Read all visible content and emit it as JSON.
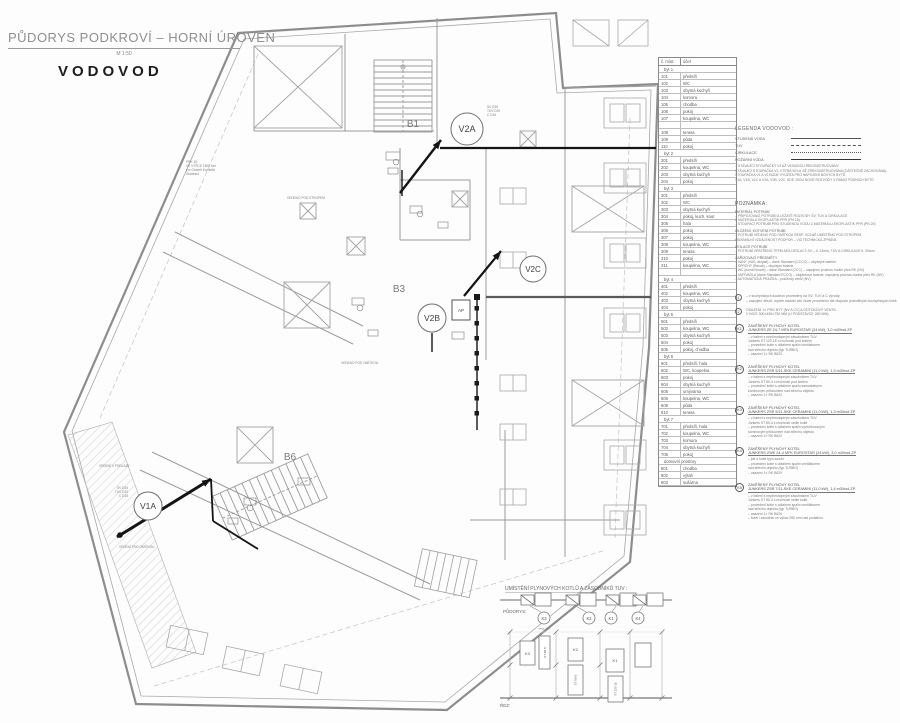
{
  "title_block": {
    "title": "PŮDORYS PODKROVÍ – HORNÍ ÚROVEŇ",
    "scale": "M 1:50",
    "subtitle": "VODOVOD"
  },
  "plan": {
    "rooms": {
      "b1": "B1",
      "b3": "B3",
      "b6": "B6"
    },
    "risers": {
      "v2a": "V2A",
      "v2b": "V2B",
      "v2c": "V2C",
      "v1a": "V1A"
    },
    "pipe_labels": {
      "v2a": "SV D25\nTUV D20\nC D16",
      "v1a": "SV D25\nTUV D20\nC D16"
    },
    "annotations": {
      "pod_stropem": "VEDENO POD STROPEM",
      "pod_omitkou": "VEDENO POD OMÍTKOU",
      "v_podlaze": "VEDENÍ V PODLAZE",
      "pod_omitkou2": "VEDENÍ POD OMÍTKOU",
      "prk": "PRK 15\nVE VÝŠCE 1500 mm\npro Geberit Kombifix\nStandard",
      "ap": "AP"
    }
  },
  "room_schedule": {
    "headers": [
      "č. míst.",
      "účel"
    ],
    "rows": [
      {
        "t": "g",
        "num": "byt 1",
        "name": ""
      },
      {
        "t": "r",
        "num": "101",
        "name": "předsíň"
      },
      {
        "t": "r",
        "num": "102",
        "name": "WC"
      },
      {
        "t": "r",
        "num": "103",
        "name": "obytná kuchyň"
      },
      {
        "t": "r",
        "num": "104",
        "name": "komora"
      },
      {
        "t": "r",
        "num": "105",
        "name": "chodba"
      },
      {
        "t": "r",
        "num": "106",
        "name": "pokoj"
      },
      {
        "t": "r",
        "num": "107",
        "name": "koupelna, WC"
      },
      {
        "t": "b",
        "num": "",
        "name": ""
      },
      {
        "t": "r",
        "num": "108",
        "name": "terasa"
      },
      {
        "t": "r",
        "num": "109",
        "name": "půda"
      },
      {
        "t": "r",
        "num": "110",
        "name": "pokoj"
      },
      {
        "t": "g",
        "num": "byt 2",
        "name": ""
      },
      {
        "t": "r",
        "num": "201",
        "name": "předsíň"
      },
      {
        "t": "r",
        "num": "202",
        "name": "koupelna, WC"
      },
      {
        "t": "r",
        "num": "203",
        "name": "obytná kuchyň"
      },
      {
        "t": "r",
        "num": "204",
        "name": "pokoj"
      },
      {
        "t": "g",
        "num": "byt 3",
        "name": ""
      },
      {
        "t": "r",
        "num": "301",
        "name": "předsíň"
      },
      {
        "t": "r",
        "num": "302",
        "name": "WC"
      },
      {
        "t": "r",
        "num": "303",
        "name": "obytná kuchyň"
      },
      {
        "t": "r",
        "num": "304",
        "name": "pokoj, kuch. kout"
      },
      {
        "t": "r",
        "num": "305",
        "name": "hala"
      },
      {
        "t": "r",
        "num": "306",
        "name": "pokoj"
      },
      {
        "t": "r",
        "num": "307",
        "name": "pokoj"
      },
      {
        "t": "r",
        "num": "308",
        "name": "koupelna, WC"
      },
      {
        "t": "r",
        "num": "309",
        "name": "terasa"
      },
      {
        "t": "r",
        "num": "310",
        "name": "pokoj"
      },
      {
        "t": "r",
        "num": "311",
        "name": "koupelna, WC"
      },
      {
        "t": "b",
        "num": "",
        "name": ""
      },
      {
        "t": "g",
        "num": "byt 4",
        "name": ""
      },
      {
        "t": "r",
        "num": "401",
        "name": "předsíň"
      },
      {
        "t": "r",
        "num": "402",
        "name": "koupelna, WC"
      },
      {
        "t": "r",
        "num": "403",
        "name": "obytná kuchyň"
      },
      {
        "t": "r",
        "num": "404",
        "name": "pokoj"
      },
      {
        "t": "g",
        "num": "byt 5",
        "name": ""
      },
      {
        "t": "r",
        "num": "501",
        "name": "předsíň"
      },
      {
        "t": "r",
        "num": "502",
        "name": "koupelna, WC"
      },
      {
        "t": "r",
        "num": "503",
        "name": "obytná kuchyň"
      },
      {
        "t": "r",
        "num": "504",
        "name": "pokoj"
      },
      {
        "t": "r",
        "num": "505",
        "name": "pokoj, chodba"
      },
      {
        "t": "g",
        "num": "byt 6",
        "name": ""
      },
      {
        "t": "r",
        "num": "601",
        "name": "předsíň, hala"
      },
      {
        "t": "r",
        "num": "602",
        "name": "WC, koupelna"
      },
      {
        "t": "r",
        "num": "603",
        "name": "pokoj"
      },
      {
        "t": "r",
        "num": "604",
        "name": "obytná kuchyň"
      },
      {
        "t": "r",
        "num": "605",
        "name": "umývárna"
      },
      {
        "t": "r",
        "num": "606",
        "name": "koupelna, WC"
      },
      {
        "t": "r",
        "num": "609",
        "name": "půda"
      },
      {
        "t": "r",
        "num": "610",
        "name": "terasa"
      },
      {
        "t": "g",
        "num": "byt 7",
        "name": ""
      },
      {
        "t": "r",
        "num": "701",
        "name": "předsíň, hala"
      },
      {
        "t": "r",
        "num": "702",
        "name": "koupelna, WC"
      },
      {
        "t": "r",
        "num": "703",
        "name": "komora"
      },
      {
        "t": "r",
        "num": "704",
        "name": "obytná kuchyň"
      },
      {
        "t": "r",
        "num": "705",
        "name": "pokoj"
      },
      {
        "t": "g",
        "num": "domovní prostory",
        "name": ""
      },
      {
        "t": "r",
        "num": "801",
        "name": "chodba"
      },
      {
        "t": "r",
        "num": "802",
        "name": "výtah"
      },
      {
        "t": "r",
        "num": "803",
        "name": "sušárna"
      }
    ]
  },
  "legend": {
    "title": "LEGENDA VODOVOD :",
    "items": [
      {
        "label": "STUDENÁ VODA",
        "style": "solid"
      },
      {
        "label": "TUV",
        "style": "dashed"
      },
      {
        "label": "CIRKULACE",
        "style": "dashdot"
      },
      {
        "label": "POŽÁRNÍ VODA",
        "style": "bold"
      }
    ]
  },
  "riser_note": "– STÁVAJÍCÍ STOUPAČKY V2 AŽ V6 BUDOU REKONSTRUOVÁNY.\nSTÁVAJÍCÍ STOUPAČKA V1, KTERÁ BYLA JIŽ ZREKONSTRUOVÁNA (ČÁSTEČNĚ ZACHOVÁNA),\nSTOUPAČKA V1 A V2 BUDE VYUŽITA PRO NAPOJENÍ NOVÝCH BYTŮ\nV1A, V1B, V1C A V2A, V2B, V2C, KDE JSOU NOVÉ ROZVODY V RÁMCI PŮDNÍCH BYTŮ",
  "poznamka": {
    "title": "POZNÁMKA:",
    "sections": [
      {
        "heading": "MATERIÁL POTRUBÍ",
        "lines": "– PŘIPOJOVACÍ POTRUBÍ A LEŽATÉ ROZVODY SV, TUV A CIRKULACE\nZ MATERIÁLU EKOPLASTIK PPR (PN 16)\n– STOUPACÍ POTRUBÍ PRO STUDENOU VODU Z MATERIÁLU EKOPLASTIK PPR (PN 20)"
      },
      {
        "heading": "ULOŽENÍ, KOTVENÍ POTRUBÍ:",
        "lines": "– POTRUBÍ VEDENO POD OMÍTKOU RESP. VOLNĚ UMÍSTĚNO POD STROPEM,\nMAXIMÁLNÍ VZDÁLENOST PODPOR – VIZ TECHNICKÁ ZPRÁVA"
      },
      {
        "heading": "IZOLACE POTRUBÍ",
        "lines": "– POTRUBÍ OPATŘENO TEPELNOU IZOLACÍ: SV – tl. 13mm, TUV A CIRKULACE tl. 20mm"
      },
      {
        "heading": "ZAŘIZOVACÍ PŘEDMĚTY",
        "lines": "– VANY (VAS, akrylát) – dané Standard (CCCC) – obyčejné baterie\n– SPRCHY (Ravak) – obyčejné baterie\n– WC (kombi klozet) – dané Standard (CCC) – napojeno pružnou hadicí přes RK (NV)\n– UMÝVADLA (dané Standard ECCO) – stojánkové baterie, napojeny pružnou hadicí přes RK (NV)\n– AUTOMATICKÁ PRAČKA – pračkový ventil (NV)"
      }
    ]
  },
  "circle_notes": [
    {
      "num": "1",
      "text": "– v kuchyňských koutech provedeny na SV, TUV a C vývody\n– napojení dřezů, myček nádobí atd. bude provedeno dle dispozic jednotlivých kuchyňských linek"
    },
    {
      "num": "2",
      "text": "OSAZENÍ 1× PRO BYT (NV A CV) A ODTOKOVÝ VENTIL\nV NICE 300×450×750 MM (U PODSTAVCE 280 MM)"
    }
  ],
  "kotel_notes": [
    {
      "id": "K1",
      "heading": "ZAVĚŠENÝ PLYNOVÝ KOTEL",
      "model": "JUNKERS ZE 24-7 MFA EUROSTAR (24 kW), 3,0 m3/hod ZP",
      "lines": "– v balení s nepřímotopným zásobníkem TUV\nJunkers ST 120-1E s možností pod kotlem\n– provedení kotle s odtahem spalin ventilátorem\nnad střechu objektu (typ TURBO)\n– osazení 1× RK B620"
    },
    {
      "id": "K2",
      "heading": "ZAVĚŠENÝ PLYNOVÝ KOTEL",
      "model": "JUNKERS ZSR 5/11-SKE CERAMINI (11,0 kW), 1,3 m3/hod ZP",
      "lines": "– v balení s nepřímotopným zásobníkem TUV\nJunkers ST 80-4 s možností pod kotlem\n– provedení kotle s odtahem spalin samostatným\nkomínovým průduchem nad střechu objektu\n– osazení 1× RK B620"
    },
    {
      "id": "K3",
      "heading": "ZAVĚŠENÝ PLYNOVÝ KOTEL",
      "model": "JUNKERS ZSR 5/11-SKE CERAMINI (11,0 kW), 1,3 m3/hod ZP",
      "lines": "– v balení s nepřímotopným zásobníkem TUV\nJunkers ST 80-4 s možností vedle kotle\n– provedení kotle s odtahem spalin vyvložkovaným\nkomínovým průduchem nad střechu objektu\n– osazení 1× RK B620"
    },
    {
      "id": "K4",
      "heading": "ZAVĚŠENÝ PLYNOVÝ KOTEL",
      "model": "JUNKERS ZWE 24-4 MFK EUROSTAR (24 kW), 3,0 m3/hod ZP",
      "lines": "– jde o kotel typu kombi\n– provedení kotle s odtahem spalin ventilátorem\nnad střechu objektu (typ TURBO)\n– osazení 1× RK B620"
    },
    {
      "id": "K5",
      "heading": "ZAVĚŠENÝ PLYNOVÝ KOTEL",
      "model": "JUNKERS ZSR 7/11-SKE CERAMINI (11,0 kW), 1,4 m3/hod ZP",
      "lines": "– v balení s nepřímotopným zásobníkem TUV\nJunkers ST 80-4 s možností vedle kotle\n– provedení kotle s odtahem spalin ventilátorem\nnad střechu objektu (typ TURBO)\n– osazení 1× RK B620\n– kotel i zásobník ve výšce 250 mm nad podlahou"
    }
  ],
  "schematic": {
    "title": "UMÍSTĚNÍ PLYNOVÝCH KOTLŮ A ZÁSOBNÍKŮ TUV :",
    "plan_label": "PŮDORYS:",
    "section_label": "ŘEZ:",
    "resp_label": "resp. K5",
    "plan_units": [
      "K3",
      "K2",
      "K1",
      "K4"
    ],
    "section_units": {
      "k3": "K3",
      "k2": "K2",
      "k1": "K1",
      "st80a": "ST 80-5",
      "st80b": "ST 80-5",
      "st120": "ST 120-1E"
    }
  },
  "colors": {
    "wall_gray": "#8d8d8d",
    "pipe_black": "#141414",
    "text_gray": "#777777"
  }
}
